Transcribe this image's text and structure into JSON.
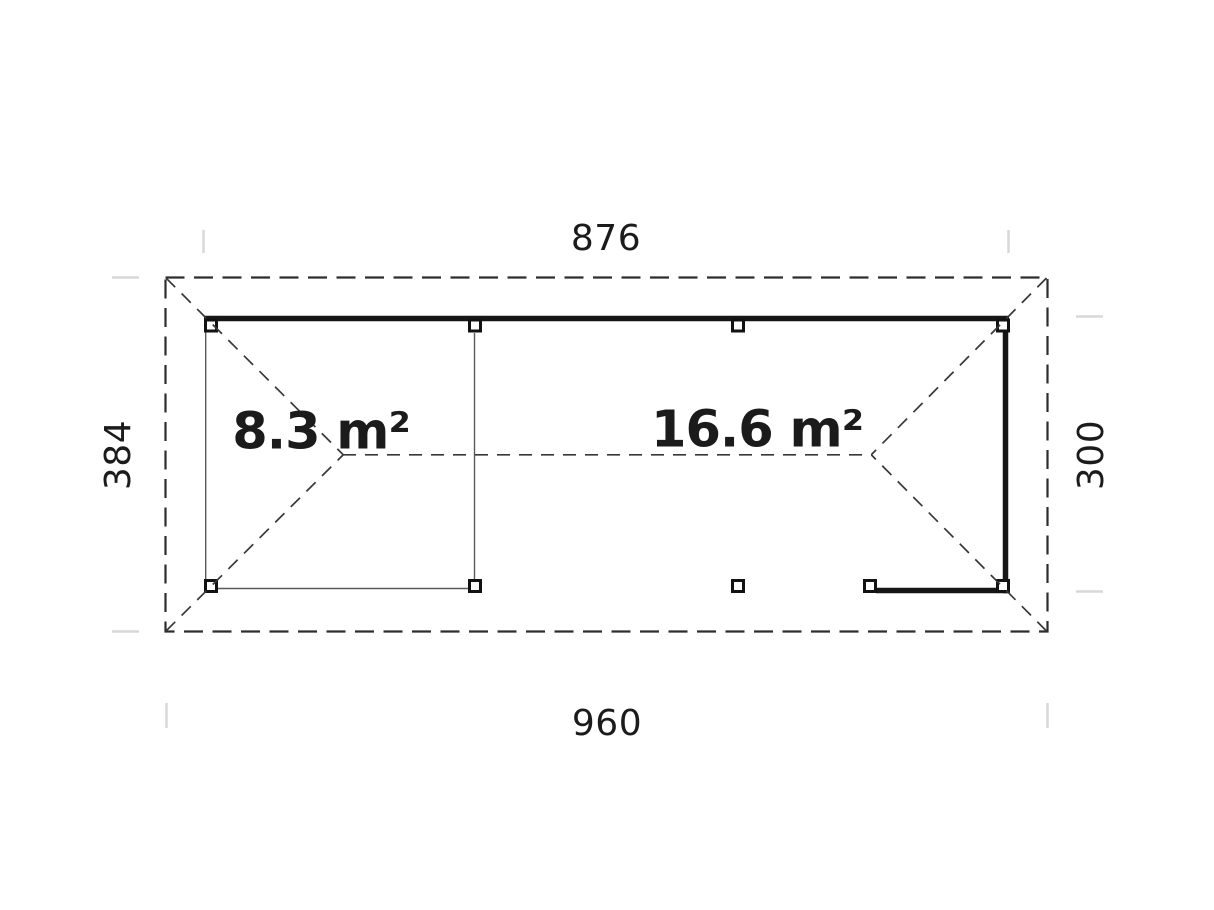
{
  "plan": {
    "dimensions": {
      "top_width": "876",
      "bottom_width": "960",
      "left_depth": "384",
      "right_depth": "300"
    },
    "areas": [
      {
        "id": "room",
        "label": "8.3 m²"
      },
      {
        "id": "terrace",
        "label": "16.6 m²"
      }
    ],
    "colors": {
      "background": "#ffffff",
      "wall_thick": "#161616",
      "wall_thin": "#5a5a5a",
      "roof_dashed": "#383838",
      "extension_tick": "#d8d8d8",
      "text": "#1b1b1b"
    }
  }
}
